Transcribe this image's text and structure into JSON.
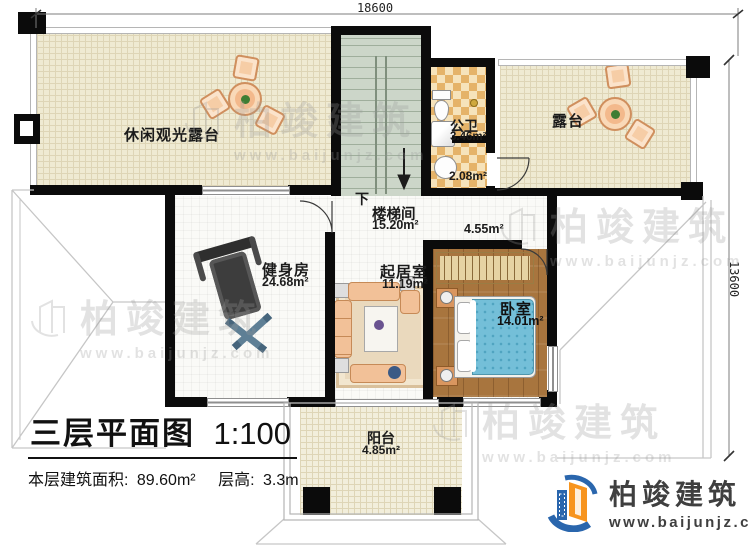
{
  "plan": {
    "title": "三层平面图",
    "scale": "1:100",
    "stats": {
      "area_label": "本层建筑面积:",
      "area_value": "89.60m²",
      "height_label": "层高:",
      "height_value": "3.3m"
    },
    "dimensions": {
      "top": "18600",
      "right": "13600"
    },
    "stair": {
      "direction": "下"
    },
    "rooms": {
      "leisure_terrace": {
        "name": "休闲观光露台"
      },
      "terrace": {
        "name": "露台"
      },
      "public_bath": {
        "name": "公卫",
        "area": "3.46m²"
      },
      "bath_lobby": {
        "area": "2.08m²"
      },
      "stairwell": {
        "name": "楼梯间",
        "area": "15.20m²"
      },
      "hall": {
        "area": "4.55m²"
      },
      "gym": {
        "name": "健身房",
        "area": "24.68m²"
      },
      "living": {
        "name": "起居室",
        "area": "11.19m²"
      },
      "bedroom": {
        "name": "卧室",
        "area": "14.01m²"
      },
      "balcony": {
        "name": "阳台",
        "area": "4.85m²"
      }
    }
  },
  "branding": {
    "company": "柏竣建筑",
    "website": "www.baijunjz.com",
    "colors": {
      "blue": "#2a66ad",
      "orange": "#f7941e",
      "text": "#3f3f3f"
    }
  },
  "colors": {
    "wall": "#0b0b0b",
    "terrace_floor": "#efead2",
    "stair_floor": "#ccd6c9",
    "bath_tile": "#e5b369",
    "wood_floor": "#a8753e",
    "bed_blue": "#74bfd8"
  }
}
